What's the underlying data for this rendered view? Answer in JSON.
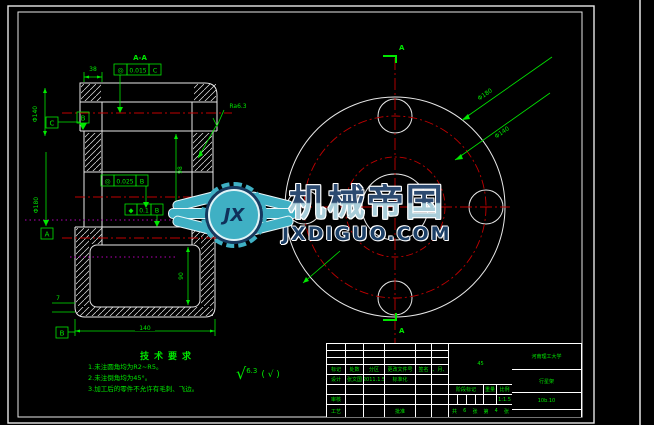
{
  "watermark": {
    "brand": "机械帝国",
    "domain": "JXDIGUO.COM",
    "monogram": "JX"
  },
  "tech_requirements": {
    "title": "技术要求",
    "items": [
      "1.未注圆角均为R2~R5。",
      "2.未注倒角均为45°。",
      "3.加工后的零件不允许有毛刺、飞边。"
    ]
  },
  "surface_note": {
    "symbol": "√",
    "value": "6.3",
    "other": "( √ )"
  },
  "left_view": {
    "section_label": "A-A",
    "fcf": [
      {
        "symbol": "◎",
        "tolerance": "0.015",
        "datum": "C"
      },
      {
        "symbol": "◎",
        "tolerance": "0.025",
        "datum": "B"
      },
      {
        "symbol": "◆",
        "tolerance": "0.1",
        "datum": "B"
      }
    ],
    "datums": [
      "C",
      "B",
      "A",
      "B"
    ],
    "dims": {
      "top_width": "38",
      "phi_upper": "Φ140",
      "phi_lower": "Φ180",
      "bore_height": "98",
      "cavity_height": "90",
      "wall": "7",
      "bottom_width": "140"
    },
    "roughness_label": "Ra6.3"
  },
  "right_view": {
    "section_mark_top": "A",
    "section_mark_bottom": "A",
    "leader_outer": "Φ180",
    "leader_bolt": "Φ140"
  },
  "title_block": {
    "revision_headers": [
      "标记",
      "处数",
      "分区",
      "更改文件号",
      "签名",
      "年、月、日"
    ],
    "design_row": {
      "label": "设计",
      "name": "张文国",
      "date": "2011.1.5",
      "std_label": "标准化"
    },
    "check_label": "审核",
    "process_label": "工艺",
    "approve_label": "批准",
    "material": "45",
    "stage_label": "阶段标记",
    "weight_label": "重量",
    "scale_label": "比例",
    "scale_value": "1:1.5",
    "sheet_info": [
      "共",
      "6",
      "张",
      "第",
      "4",
      "张"
    ],
    "school": "河南理工大学",
    "part_name": "行星架",
    "drawing_no": "10b.10"
  }
}
